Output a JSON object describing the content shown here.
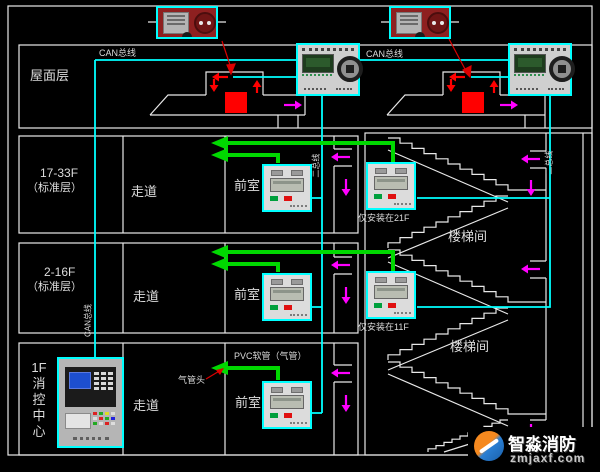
{
  "colors": {
    "background": "#000000",
    "line_white": "#e8e8e8",
    "bus_cyan": "#00ffff",
    "tube_green": "#00d800",
    "airflow_magenta": "#ff00ff",
    "fire_red": "#ff0000"
  },
  "labels": {
    "roof": "屋面层",
    "floor_17_33": "17-33F",
    "floor_17_33_sub": "（标准层）",
    "floor_2_16": "2-16F",
    "floor_2_16_sub": "（标准层）",
    "fire_center": [
      "1F",
      "消",
      "控",
      "中",
      "心"
    ],
    "corridor": "走道",
    "anteroom": "前室",
    "stairwell": "楼梯间",
    "can_bus": "CAN总线",
    "two_bus": "二总线",
    "only_21f": "仅安装在21F",
    "only_11f": "仅安装在11F",
    "pvc_tube": "PVC软管（气管）",
    "tube_head": "气管头"
  },
  "watermark": {
    "brand": "智淼消防",
    "domain": "zmjaxf.com"
  }
}
